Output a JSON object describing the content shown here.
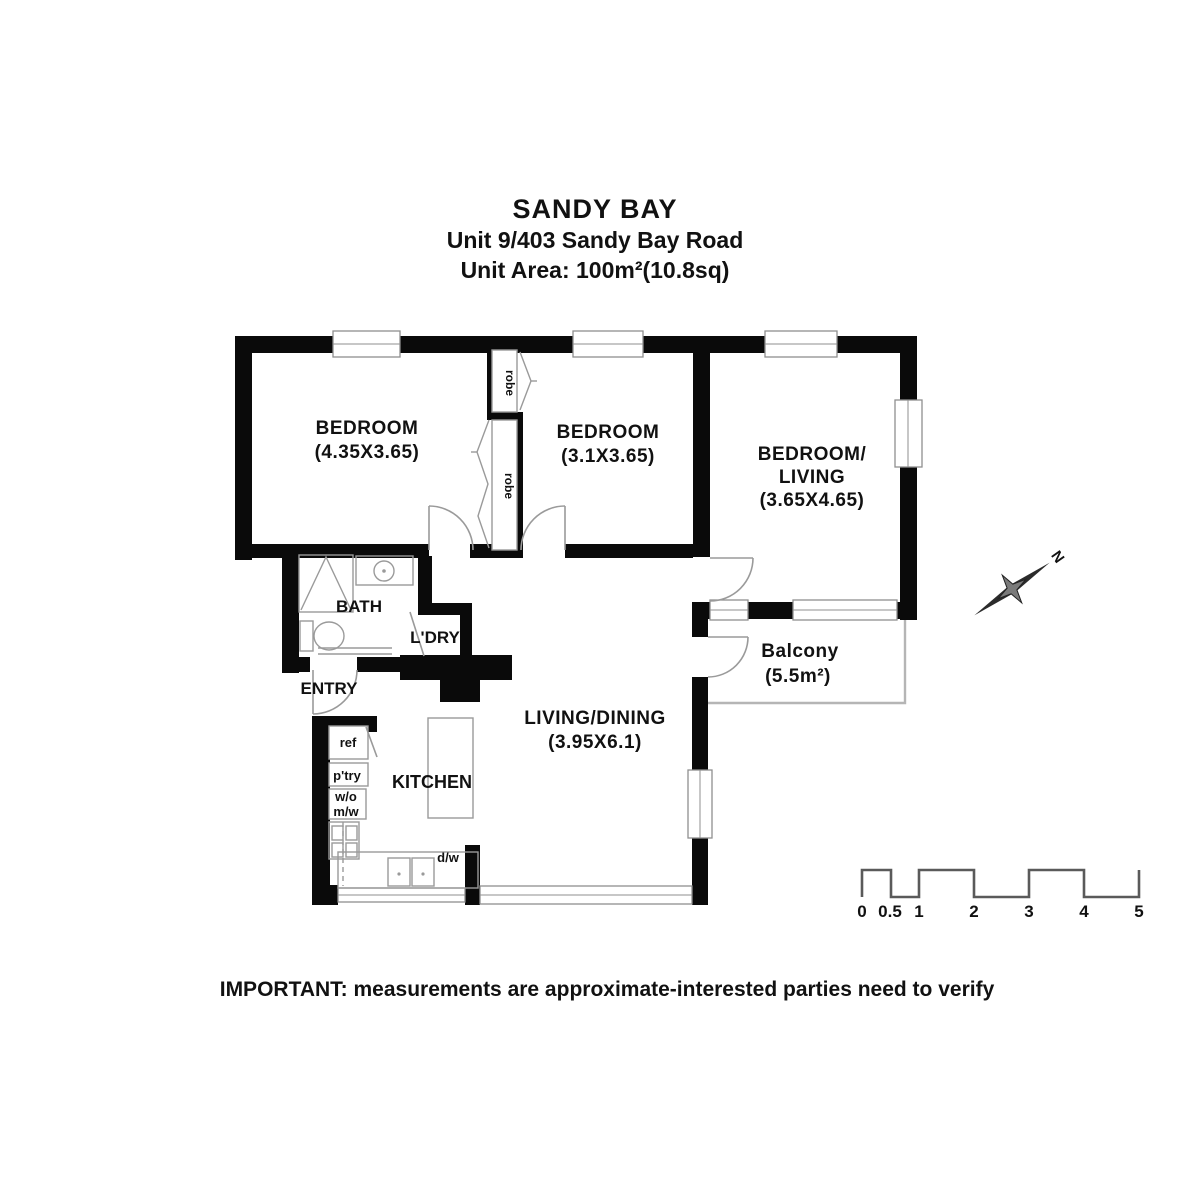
{
  "title": {
    "line1": "SANDY BAY",
    "line2": "Unit 9/403 Sandy Bay Road",
    "line3": "Unit Area: 100m²(10.8sq)"
  },
  "footer": "IMPORTANT: measurements are approximate-interested parties need to verify",
  "rooms": {
    "bedroom1": {
      "name": "BEDROOM",
      "dims": "(4.35X3.65)"
    },
    "bedroom2": {
      "name": "BEDROOM",
      "dims": "(3.1X3.65)"
    },
    "bedroom_living": {
      "name1": "BEDROOM/",
      "name2": "LIVING",
      "dims": "(3.65X4.65)"
    },
    "living_dining": {
      "name": "LIVING/DINING",
      "dims": "(3.95X6.1)"
    },
    "balcony": {
      "name": "Balcony",
      "dims": "(5.5m²)"
    },
    "bath": "BATH",
    "laundry": "L'DRY",
    "entry": "ENTRY",
    "kitchen": "KITCHEN"
  },
  "fixtures": {
    "robe_top": "robe",
    "robe_bottom": "robe",
    "fridge": "ref",
    "pantry": "p'try",
    "wall_oven": "w/o",
    "microwave": "m/w",
    "dishwasher": "d/w"
  },
  "compass": {
    "north": "N"
  },
  "scale_bar": {
    "labels": [
      "0",
      "0.5",
      "1",
      "2",
      "3",
      "4",
      "5"
    ]
  },
  "colors": {
    "wall": "#0a0a0a",
    "thin_line": "#9a9a9a",
    "balcony_line": "#b5b5b5",
    "text": "#111111"
  }
}
